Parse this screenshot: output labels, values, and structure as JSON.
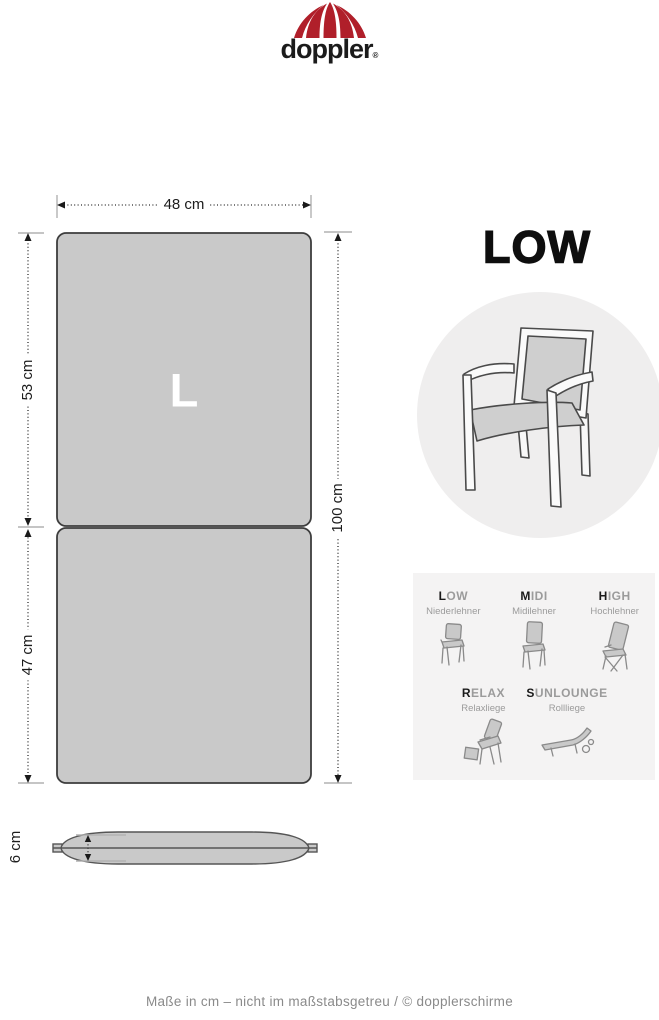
{
  "logo": {
    "brand": "doppler",
    "registered": "®"
  },
  "product": {
    "title": "LOW"
  },
  "cushion": {
    "size_letter": "L",
    "width": "48 cm",
    "back_length": "53 cm",
    "seat_length": "47 cm",
    "total_length": "100 cm",
    "thickness": "6 cm"
  },
  "legend": {
    "row1": [
      {
        "initial": "L",
        "rest": "OW",
        "subtitle": "Niederlehner"
      },
      {
        "initial": "M",
        "rest": "IDI",
        "subtitle": "Midilehner"
      },
      {
        "initial": "H",
        "rest": "IGH",
        "subtitle": "Hochlehner"
      }
    ],
    "row2": [
      {
        "initial": "R",
        "rest": "ELAX",
        "subtitle": "Relaxliege"
      },
      {
        "initial": "S",
        "rest": "UNLOUNGE",
        "subtitle": "Rollliege"
      }
    ]
  },
  "footer": {
    "text": "Maße in cm – nicht im maßstabsgetreu / © dopplerschirme"
  },
  "colors": {
    "brand_red": "#b01f2a",
    "cushion_fill": "#c9c9c9",
    "outline": "#3d3d3d",
    "circle_fill": "#efeeee",
    "panel_fill": "#f4f3f3",
    "muted_text": "#9b9b9b",
    "tick_gray": "#b2b2b2"
  }
}
